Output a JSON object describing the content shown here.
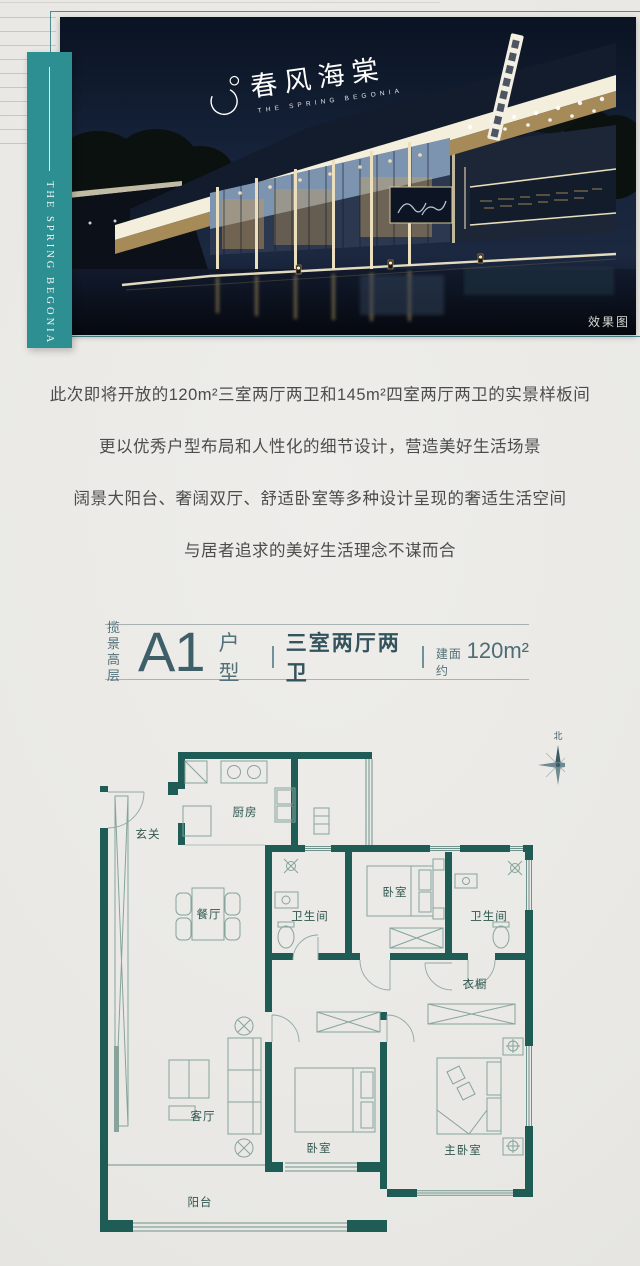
{
  "brand": {
    "ribbon_text": "THE SPRING BEGONIA",
    "logo_cn": "春风海棠",
    "logo_en": "THE SPRING BEGONIA",
    "photo_watermark": "效果图"
  },
  "intro": {
    "lines": [
      "此次即将开放的120m²三室两厅两卫和145m²四室两厅两卫的实景样板间",
      "更以优秀户型布局和人性化的细节设计，营造美好生活场景",
      "阔景大阳台、奢阔双厅、舒适卧室等多种设计呈现的奢适生活空间",
      "与居者追求的美好生活理念不谋而合"
    ]
  },
  "plan_header": {
    "tag_top": "揽景",
    "tag_bottom": "高层",
    "code": "A1",
    "type_label": "户型",
    "layout": "三室两厅两卫",
    "area_prefix": "建面约",
    "area_value": "120m²"
  },
  "floor_plan": {
    "compass": "北",
    "rooms": {
      "entry": "玄关",
      "kitchen": "厨房",
      "dining": "餐厅",
      "bath1": "卫生间",
      "bedroom_top": "卧室",
      "bath2": "卫生间",
      "closet": "衣橱",
      "living": "客厅",
      "bedroom2": "卧室",
      "master": "主卧室",
      "balcony": "阳台"
    }
  },
  "colors": {
    "wall": "#1f5c55",
    "accent": "#2e8f93",
    "header-text": "#3f5f68",
    "body-text": "#4c4c4c"
  }
}
